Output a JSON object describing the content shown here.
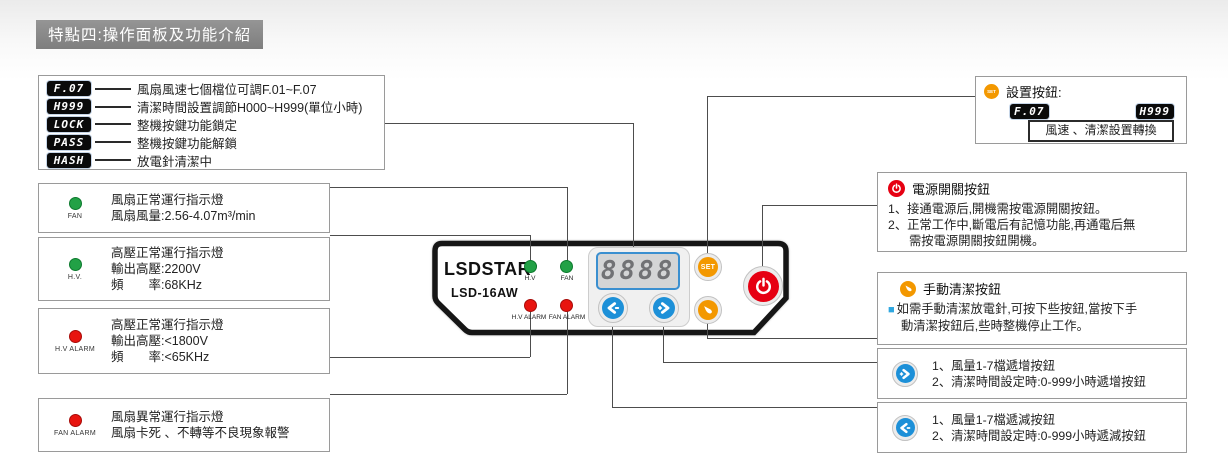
{
  "title": "特點四:操作面板及功能介紹",
  "legend": {
    "items": [
      {
        "tag": "F.07",
        "desc": "風扇風速七個檔位可調F.01~F.07"
      },
      {
        "tag": "H999",
        "desc": "清潔時間設置調節H000~H999(單位小時)"
      },
      {
        "tag": "LOCK",
        "desc": "整機按鍵功能鎖定"
      },
      {
        "tag": "PASS",
        "desc": "整機按鍵功能解鎖"
      },
      {
        "tag": "HASH",
        "desc": "放電針清潔中"
      }
    ]
  },
  "indicators": {
    "fan": {
      "led_label": "FAN",
      "lines": [
        "風扇正常運行指示燈",
        "風扇風量:2.56-4.07m³/min"
      ]
    },
    "hv": {
      "led_label": "H.V.",
      "lines": [
        "高壓正常運行指示燈",
        "輸出高壓:2200V",
        "頻　　率:68KHz"
      ]
    },
    "hv_alarm": {
      "led_label": "H.V ALARM",
      "lines": [
        "高壓正常運行指示燈",
        "輸出高壓:<1800V",
        "頻　　率:<65KHz"
      ]
    },
    "fan_alarm": {
      "led_label": "FAN ALARM",
      "lines": [
        "風扇異常運行指示燈",
        "風扇卡死 、不轉等不良現象報警"
      ]
    }
  },
  "panel": {
    "brand": "LSDSTAR",
    "reg": "®",
    "model": "LSD-16AW",
    "display_value": "8888",
    "set_label": "SET",
    "led_labels": {
      "hv": "H.V",
      "fan": "FAN",
      "hv_alarm": "H.V ALARM",
      "fan_alarm": "FAN ALARM"
    }
  },
  "set_box": {
    "icon_label": "SET",
    "title": "設置按鈕:",
    "tag_left": "F.07",
    "tag_right": "H999",
    "toggle_text": "風速 、清潔設置轉換"
  },
  "power_box": {
    "title": "電源開關按鈕",
    "lines": [
      "1、接通電源后,開機需按電源開關按鈕。",
      "2、正常工作中,斷電后有記憶功能,再通電后無",
      "需按電源開關按鈕開機。"
    ]
  },
  "clean_box": {
    "title": "手動清潔按鈕",
    "bullet": "■",
    "lines": [
      "如需手動清潔放電針,可按下些按鈕,當按下手",
      "動清潔按鈕后,些時整機停止工作。"
    ]
  },
  "inc_box": {
    "lines": [
      "1、風量1-7檔遞增按鈕",
      "2、清潔時間設定時:0-999小時遞增按鈕"
    ]
  },
  "dec_box": {
    "lines": [
      "1、風量1-7檔遞減按鈕",
      "2、清潔時間設定時:0-999小時遞減按鈕"
    ]
  },
  "colors": {
    "banner_gray": "#8a8a8a",
    "accent_orange": "#f39800",
    "accent_blue": "#1d90d8",
    "accent_red": "#e60012",
    "led_green": "#22a146",
    "led_red": "#e8140f",
    "display_blue": "#3a8fd0",
    "line_gray": "#4d4d4d"
  }
}
